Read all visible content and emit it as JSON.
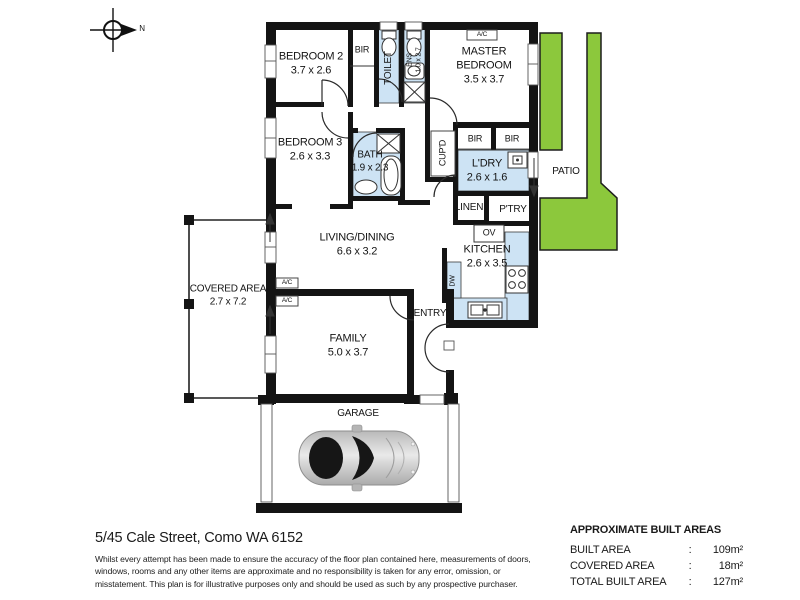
{
  "compass": {
    "label": "N"
  },
  "rooms": {
    "bedroom2": {
      "label": "BEDROOM 2",
      "dims": "3.7 x 2.6"
    },
    "bir1": {
      "label": "BIR"
    },
    "toilet": {
      "label": "TOILET"
    },
    "ens": {
      "label": "ENS",
      "dims": "1.0 x 2.7"
    },
    "master": {
      "label": "MASTER BEDROOM",
      "dims": "3.5 x 3.7"
    },
    "bedroom3": {
      "label": "BEDROOM 3",
      "dims": "2.6 x 3.3"
    },
    "bath": {
      "label": "BATH",
      "dims": "1.9 x 2.3"
    },
    "cupd": {
      "label": "CUP'D"
    },
    "bir2": {
      "label": "BIR"
    },
    "bir3": {
      "label": "BIR"
    },
    "ldry": {
      "label": "L'DRY",
      "dims": "2.6 x 1.6"
    },
    "patio": {
      "label": "PATIO"
    },
    "linen": {
      "label": "LINEN"
    },
    "ptry": {
      "label": "P'TRY"
    },
    "ov": {
      "label": "OV"
    },
    "kitchen": {
      "label": "KITCHEN",
      "dims": "2.6 x 3.5"
    },
    "dw": {
      "label": "DW"
    },
    "living": {
      "label": "LIVING/DINING",
      "dims": "6.6 x 3.2"
    },
    "covered": {
      "label": "COVERED AREA",
      "dims": "2.7 x 7.2"
    },
    "family": {
      "label": "FAMILY",
      "dims": "5.0 x 3.7"
    },
    "entry": {
      "label": "ENTRY"
    },
    "garage": {
      "label": "GARAGE"
    },
    "ac": {
      "label": "A/C"
    }
  },
  "footer": {
    "address": "5/45 Cale Street, Como WA 6152",
    "disclaimer": "Whilst every attempt has been made to ensure the accuracy of the floor plan contained here, measurements of doors, windows, rooms and any other items are approximate and no responsibility is taken for any error, omission, or misstatement. This plan is for illustrative purposes only and should be used as such by any prospective purchaser."
  },
  "areas": {
    "title": "APPROXIMATE BUILT AREAS",
    "rows": [
      {
        "label": "BUILT AREA",
        "sep": ":",
        "value": "109m²"
      },
      {
        "label": "COVERED AREA",
        "sep": ":",
        "value": "18m²"
      },
      {
        "label": "TOTAL BUILT AREA",
        "sep": ":",
        "value": "127m²"
      }
    ]
  },
  "colors": {
    "wet_area": "#cde3f4",
    "garden": "#8cc83c",
    "wall": "#141414"
  }
}
